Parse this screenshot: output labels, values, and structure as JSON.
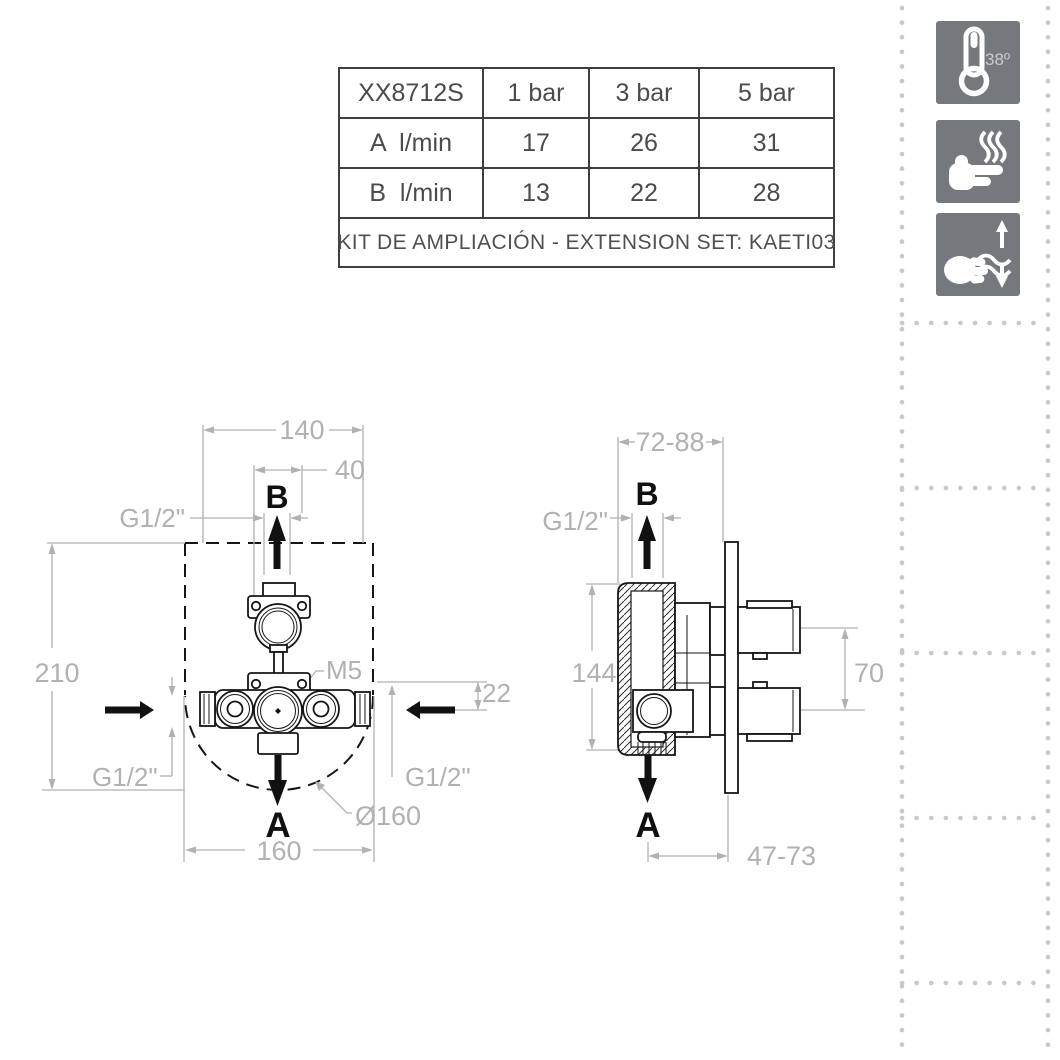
{
  "table": {
    "header": [
      "XX8712S",
      "1 bar",
      "3 bar",
      "5 bar"
    ],
    "rows": [
      {
        "label": "A  l/min",
        "values": [
          "17",
          "26",
          "31"
        ]
      },
      {
        "label": "B  l/min",
        "values": [
          "13",
          "22",
          "28"
        ]
      }
    ],
    "footer": "KIT DE AMPLIACIÓN - EXTENSION SET: KAETI03"
  },
  "icons": {
    "thermostat_temp": "38º",
    "names": [
      "thermostat-38-degrees",
      "anti-scald-hand-heat",
      "flow-adjust-hand"
    ]
  },
  "front_view": {
    "dim_box_width": "140",
    "dim_outlet_offset": "40",
    "thread_top": "G1/2\"",
    "dim_height": "210",
    "screw": "M5",
    "dim_inlet_depth": "22",
    "thread_left": "G1/2\"",
    "thread_right": "G1/2\"",
    "recess_diameter": "Ø160",
    "dim_width": "160",
    "outlet_top": "B",
    "outlet_bottom": "A"
  },
  "side_view": {
    "dim_depth_range": "72-88",
    "thread_top": "G1/2\"",
    "dim_height": "144",
    "dim_port_spacing": "70",
    "dim_outlet_range": "47-73",
    "outlet_top": "B",
    "outlet_bottom": "A"
  },
  "colors": {
    "dimension_gray": "#b1b1b1",
    "drawing_black": "#161616",
    "icon_background": "#75797e",
    "table_border": "#3f3f3f",
    "table_text": "#4b4b4b",
    "dot_gray": "#c8c8c8"
  }
}
